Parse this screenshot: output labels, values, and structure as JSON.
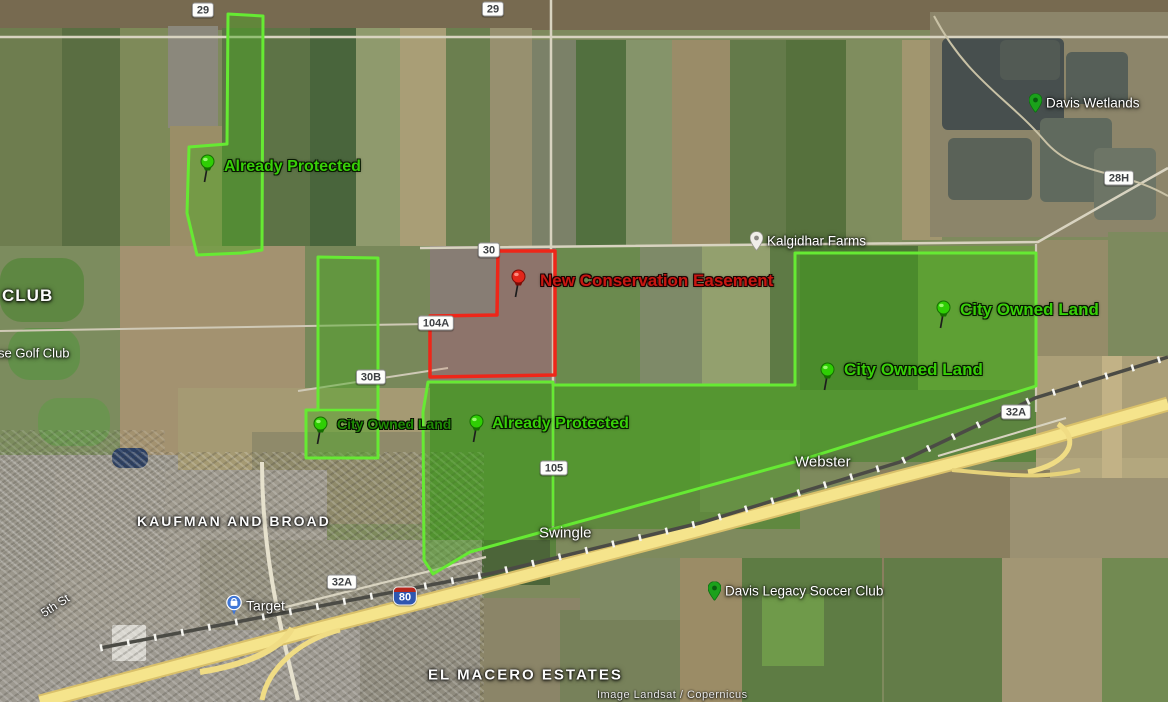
{
  "attribution": "Image Landsat / Copernicus",
  "colors": {
    "protected_border_green": "#66ea33",
    "protected_fill_green": "rgba(74,168,34,0.45)",
    "placemark_text_green": "#38cf08",
    "placemark_text_dark_green": "#1f8a04",
    "easement_border_red": "#ee2619",
    "easement_text_red": "#c81712",
    "freeway_yellow": "#f5e48c",
    "poi_pin_green": "#1ba11b",
    "target_pin_blue": "#3f76d6"
  },
  "road_shields": [
    {
      "id": "shield-29-west",
      "label": "29",
      "type": "county",
      "x": 203,
      "y": 10
    },
    {
      "id": "shield-29-east",
      "label": "29",
      "type": "county",
      "x": 493,
      "y": 9
    },
    {
      "id": "shield-30",
      "label": "30",
      "type": "county",
      "x": 489,
      "y": 250
    },
    {
      "id": "shield-104a",
      "label": "104A",
      "type": "county",
      "x": 436,
      "y": 323
    },
    {
      "id": "shield-30b",
      "label": "30B",
      "type": "county",
      "x": 371,
      "y": 377
    },
    {
      "id": "shield-105",
      "label": "105",
      "type": "county",
      "x": 554,
      "y": 468
    },
    {
      "id": "shield-32a-west",
      "label": "32A",
      "type": "county",
      "x": 342,
      "y": 582
    },
    {
      "id": "shield-32a-east",
      "label": "32A",
      "type": "county",
      "x": 1016,
      "y": 412
    },
    {
      "id": "shield-28h",
      "label": "28H",
      "type": "county",
      "x": 1119,
      "y": 178
    },
    {
      "id": "shield-i80",
      "label": "80",
      "type": "interstate",
      "x": 405,
      "y": 596
    }
  ],
  "place_labels": [
    {
      "id": "club",
      "text": "CLUB",
      "x": 2,
      "y": 296,
      "size": 17,
      "bold": true,
      "ls": 1,
      "interactable": false
    },
    {
      "id": "golf-club",
      "text": "se Golf Club",
      "x": -2,
      "y": 353,
      "size": 13,
      "interactable": false
    },
    {
      "id": "kaufman-broad",
      "text": "KAUFMAN AND BROAD",
      "x": 137,
      "y": 521,
      "size": 14,
      "bold": true,
      "ls": 2,
      "interactable": false
    },
    {
      "id": "fifth-st",
      "text": "5th St",
      "x": 42,
      "y": 614,
      "size": 12,
      "rotate": -33,
      "interactable": false
    },
    {
      "id": "target",
      "text": "Target",
      "x": 226,
      "y": 605,
      "size": 14,
      "pin": "target",
      "interactable": true
    },
    {
      "id": "swingle",
      "text": "Swingle",
      "x": 539,
      "y": 533,
      "size": 15,
      "interactable": false
    },
    {
      "id": "webster",
      "text": "Webster",
      "x": 795,
      "y": 462,
      "size": 15,
      "interactable": false
    },
    {
      "id": "soccer-club",
      "text": "Davis Legacy Soccer Club",
      "x": 708,
      "y": 591,
      "size": 13.5,
      "pin": "green",
      "interactable": true
    },
    {
      "id": "el-macero",
      "text": "EL MACERO ESTATES",
      "x": 428,
      "y": 675,
      "size": 15,
      "bold": true,
      "ls": 2,
      "interactable": false
    },
    {
      "id": "kalgidhar-farms",
      "text": "Kalgidhar Farms",
      "x": 750,
      "y": 241,
      "size": 13.5,
      "pin": "gray",
      "interactable": true
    },
    {
      "id": "davis-wetlands",
      "text": "Davis Wetlands",
      "x": 1029,
      "y": 103,
      "size": 13.5,
      "pin": "green",
      "interactable": true
    }
  ],
  "placemarks": [
    {
      "id": "already-protected-nw",
      "text": "Already Protected",
      "style": "green",
      "size": 16,
      "pin_x": 207,
      "pin_y": 161,
      "text_x": 224,
      "text_y": 167
    },
    {
      "id": "new-conservation-easement",
      "text": "New Conservation Easement",
      "style": "red",
      "size": 17,
      "pin_x": 518,
      "pin_y": 276,
      "text_x": 540,
      "text_y": 281
    },
    {
      "id": "city-owned-land-east",
      "text": "City Owned Land",
      "style": "green",
      "size": 17,
      "pin_x": 943,
      "pin_y": 307,
      "text_x": 960,
      "text_y": 310
    },
    {
      "id": "city-owned-land-mid",
      "text": "City Owned Land",
      "style": "green",
      "size": 17,
      "pin_x": 827,
      "pin_y": 369,
      "text_x": 844,
      "text_y": 370
    },
    {
      "id": "city-owned-land-small",
      "text": "City Owned Land",
      "style": "darkgreen",
      "size": 14,
      "pin_x": 320,
      "pin_y": 423,
      "text_x": 337,
      "text_y": 424
    },
    {
      "id": "already-protected-central",
      "text": "Already Protected",
      "style": "green",
      "size": 16,
      "pin_x": 476,
      "pin_y": 421,
      "text_x": 492,
      "text_y": 424
    }
  ]
}
